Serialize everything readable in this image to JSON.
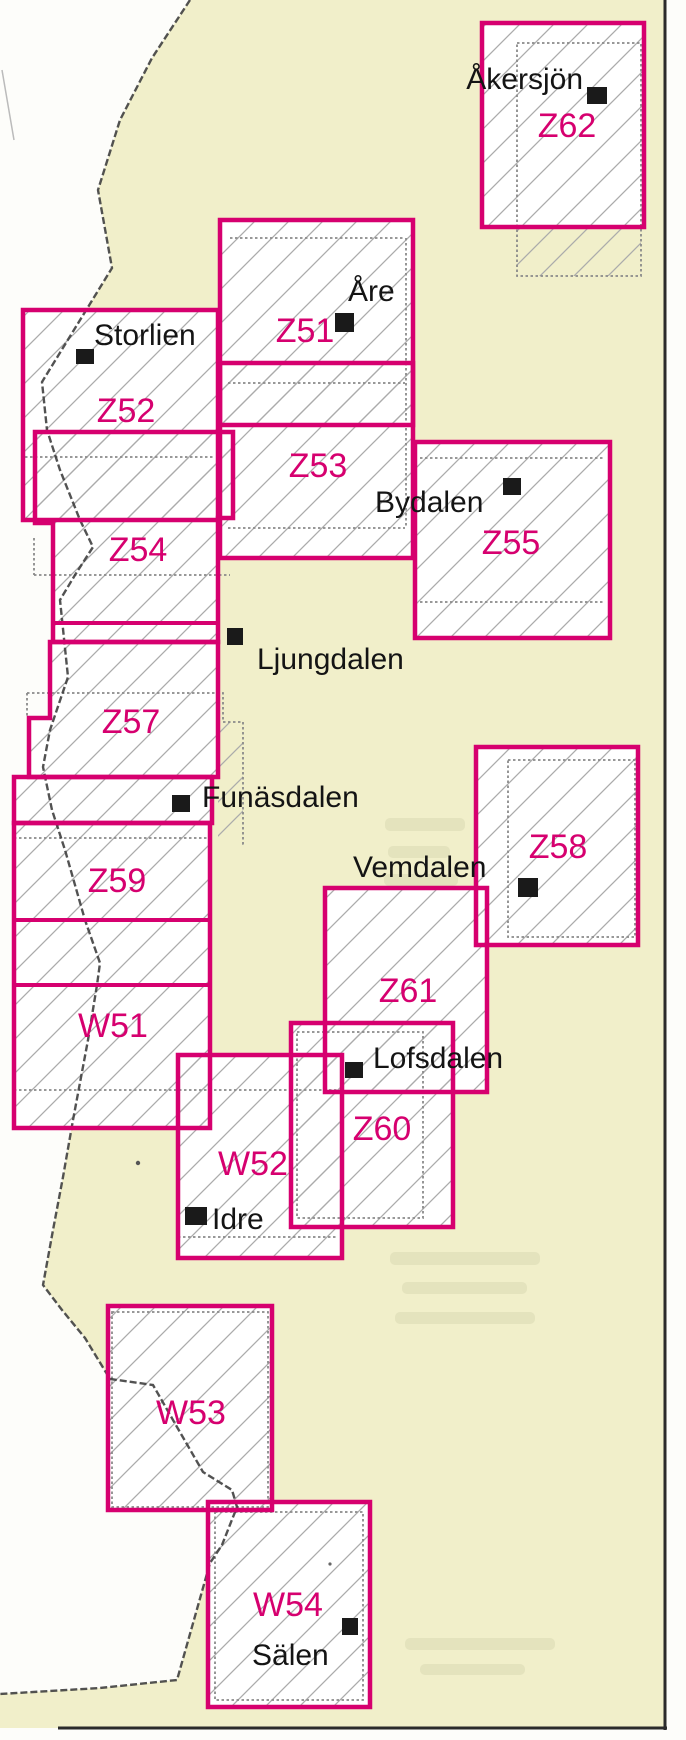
{
  "sheet_codes": [
    "Z62",
    "Z51",
    "Z52",
    "Z53",
    "Z54",
    "Z55",
    "Z57",
    "Z58",
    "Z59",
    "W51",
    "Z61",
    "Z60",
    "W52",
    "W53",
    "W54"
  ],
  "places": [
    "Åkersjön",
    "Åre",
    "Storlien",
    "Bydalen",
    "Ljungdalen",
    "Funäsdalen",
    "Vemdalen",
    "Lofsdalen",
    "Idre",
    "Sälen"
  ],
  "colors": {
    "sheet_outline": "#d6006f",
    "land": "#f1efca",
    "hatch": "#ababab",
    "national_border": "#3f3f3f",
    "frame": "#2b2b2b",
    "place_text": "#141414"
  }
}
